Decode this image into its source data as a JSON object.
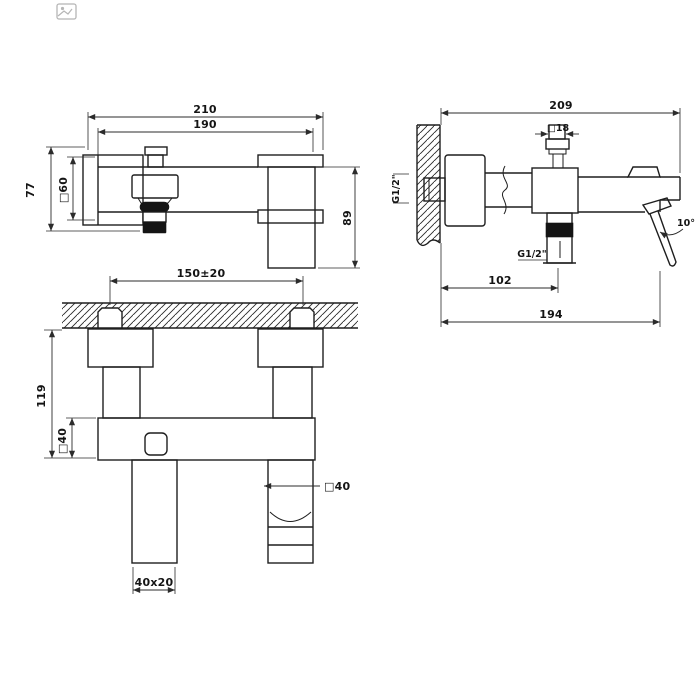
{
  "page": {
    "background": "#ffffff",
    "line_color": "#1e1e1e",
    "dim_color": "#2b2b2b"
  },
  "icons": {
    "broken_image": "broken-image"
  },
  "drawing": {
    "views": {
      "top": {
        "dims": {
          "overall_width": "210",
          "body_width": "190",
          "holder_height": "77",
          "holder_square": "□60",
          "flange_height": "89"
        }
      },
      "side": {
        "dims": {
          "overall_depth": "209",
          "connector_square": "□18",
          "inlet_thread": "G1/2\"",
          "outlet_thread": "G1/2\"",
          "outlet_depth": "102",
          "lever_depth": "194",
          "lever_angle": "10°"
        }
      },
      "front": {
        "dims": {
          "inlet_centers": "150±20",
          "total_height": "119",
          "body_square": "□40",
          "spout_square": "□40",
          "handshower_section": "40x20"
        }
      }
    }
  }
}
